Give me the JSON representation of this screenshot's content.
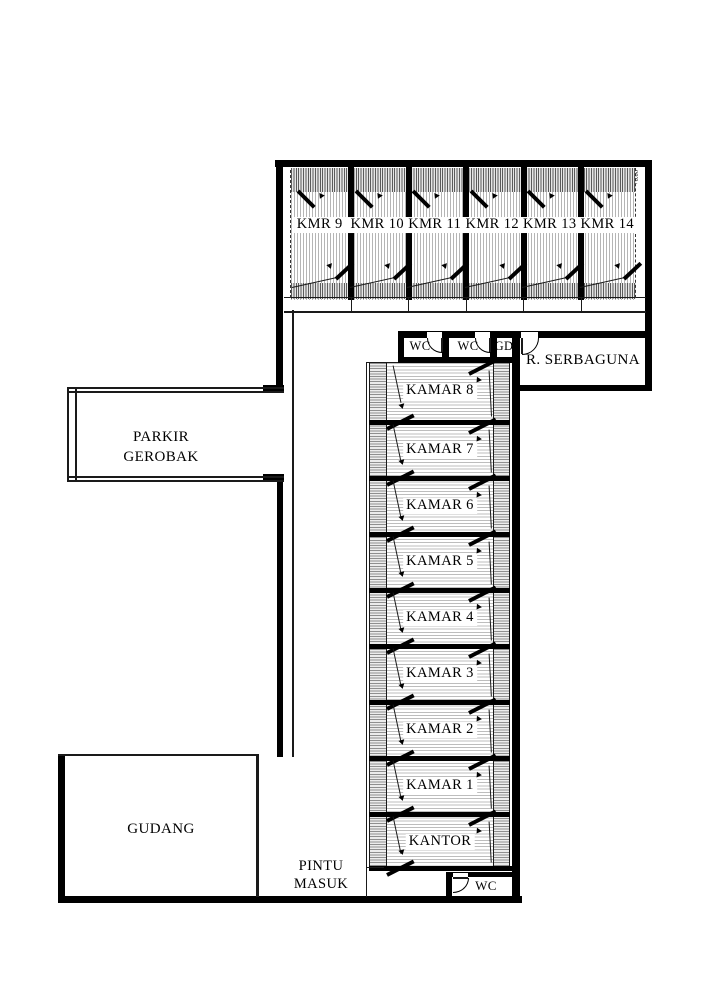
{
  "plan": {
    "top_rooms": [
      "KMR 9",
      "KMR 10",
      "KMR 11",
      "KMR 12",
      "KMR 13",
      "KMR 14"
    ],
    "service_row": [
      "WC",
      "WC",
      "GD"
    ],
    "multipurpose_room": "R. SERBAGUNA",
    "column_rooms": [
      "KAMAR 8",
      "KAMAR 7",
      "KAMAR 6",
      "KAMAR 5",
      "KAMAR 4",
      "KAMAR 3",
      "KAMAR 2",
      "KAMAR 1",
      "KANTOR"
    ],
    "parkir_line1": "PARKIR",
    "parkir_line2": "GEROBAK",
    "gudang": "GUDANG",
    "pintu_line1": "PINTU",
    "pintu_line2": "MASUK",
    "wc_bottom": "WC",
    "level_mark": "+0.00"
  },
  "colors": {
    "wall": "#000000",
    "line": "#1a1a1a",
    "paper": "#ffffff"
  }
}
